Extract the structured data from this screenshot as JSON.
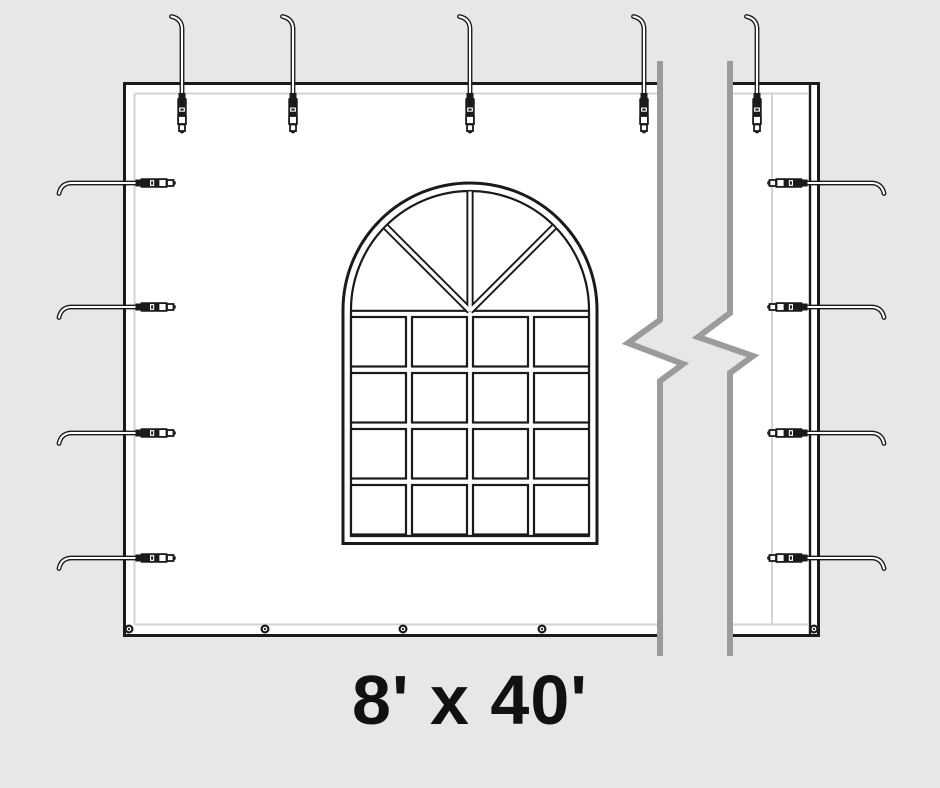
{
  "page": {
    "background_color": "#e7e7e7",
    "label": "8' x 40'",
    "label_color": "#111111"
  },
  "diagram": {
    "subject": "tent-sidewall-panel",
    "panel": {
      "fill": "#ffffff",
      "line_color": "#1a1a1a",
      "inner_seam_color": "#d3d3d3"
    },
    "window": {
      "style": "cathedral-arched-window",
      "grid_rows": 4,
      "grid_cols": 4,
      "fan_spokes": 3
    },
    "straps": {
      "top_count": 5,
      "left_count": 4,
      "right_count": 4
    },
    "grommets": {
      "bottom_count": 5
    },
    "break_mark": {
      "color": "#9b9b9b"
    }
  }
}
